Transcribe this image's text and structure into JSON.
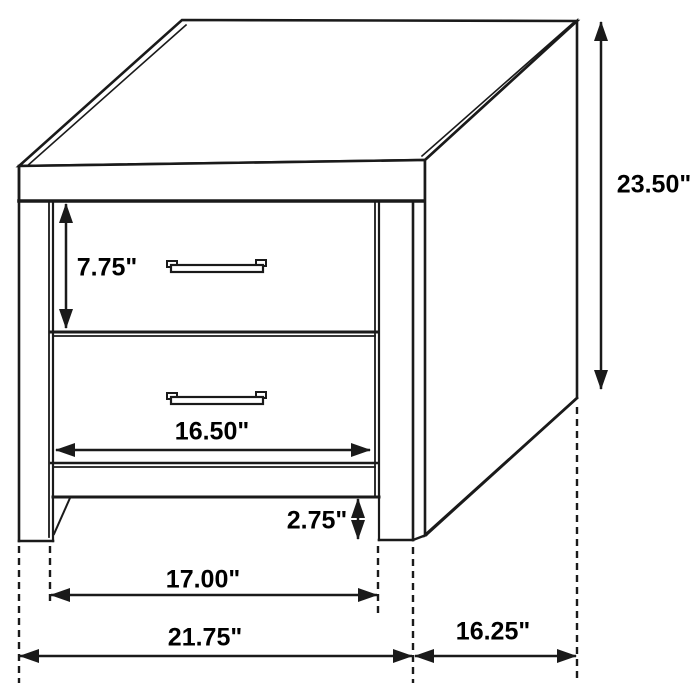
{
  "figure": {
    "subject": "two-drawer nightstand",
    "view": "three-quarter line drawing with dimension callouts",
    "units": "inches"
  },
  "dimensions": {
    "overall_height": "23.50\"",
    "drawer_face_height": "7.75\"",
    "drawer_width": "16.50\"",
    "base_clearance_height": "2.75\"",
    "inner_leg_span": "17.00\"",
    "overall_width": "21.75\"",
    "side_depth": "16.25\""
  },
  "colors": {
    "background": "#ffffff",
    "line": "#1a1a1a",
    "text": "#000000"
  }
}
